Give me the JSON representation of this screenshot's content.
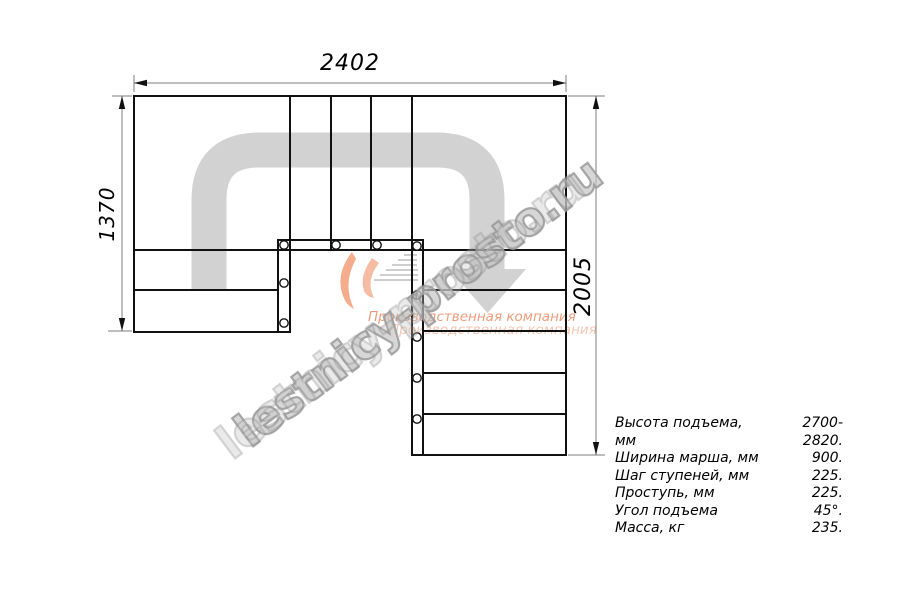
{
  "dimensions": {
    "width_top": "2402",
    "height_left": "1370",
    "height_right": "2005"
  },
  "specs": [
    {
      "label": "Высота подъема, мм",
      "value": "2700-2820."
    },
    {
      "label": "Ширина марша, мм",
      "value": "900."
    },
    {
      "label": "Шаг ступеней, мм",
      "value": "225."
    },
    {
      "label": "Проступь, мм",
      "value": "225."
    },
    {
      "label": "Угол подъема",
      "value": "45°."
    },
    {
      "label": "Масса, кг",
      "value": "235."
    }
  ],
  "watermark": {
    "site": "lestnicy-prosto.ru",
    "company": "Производственная компания",
    "accent_color": "#e8835a",
    "gray_color": "#a0a0a0"
  }
}
